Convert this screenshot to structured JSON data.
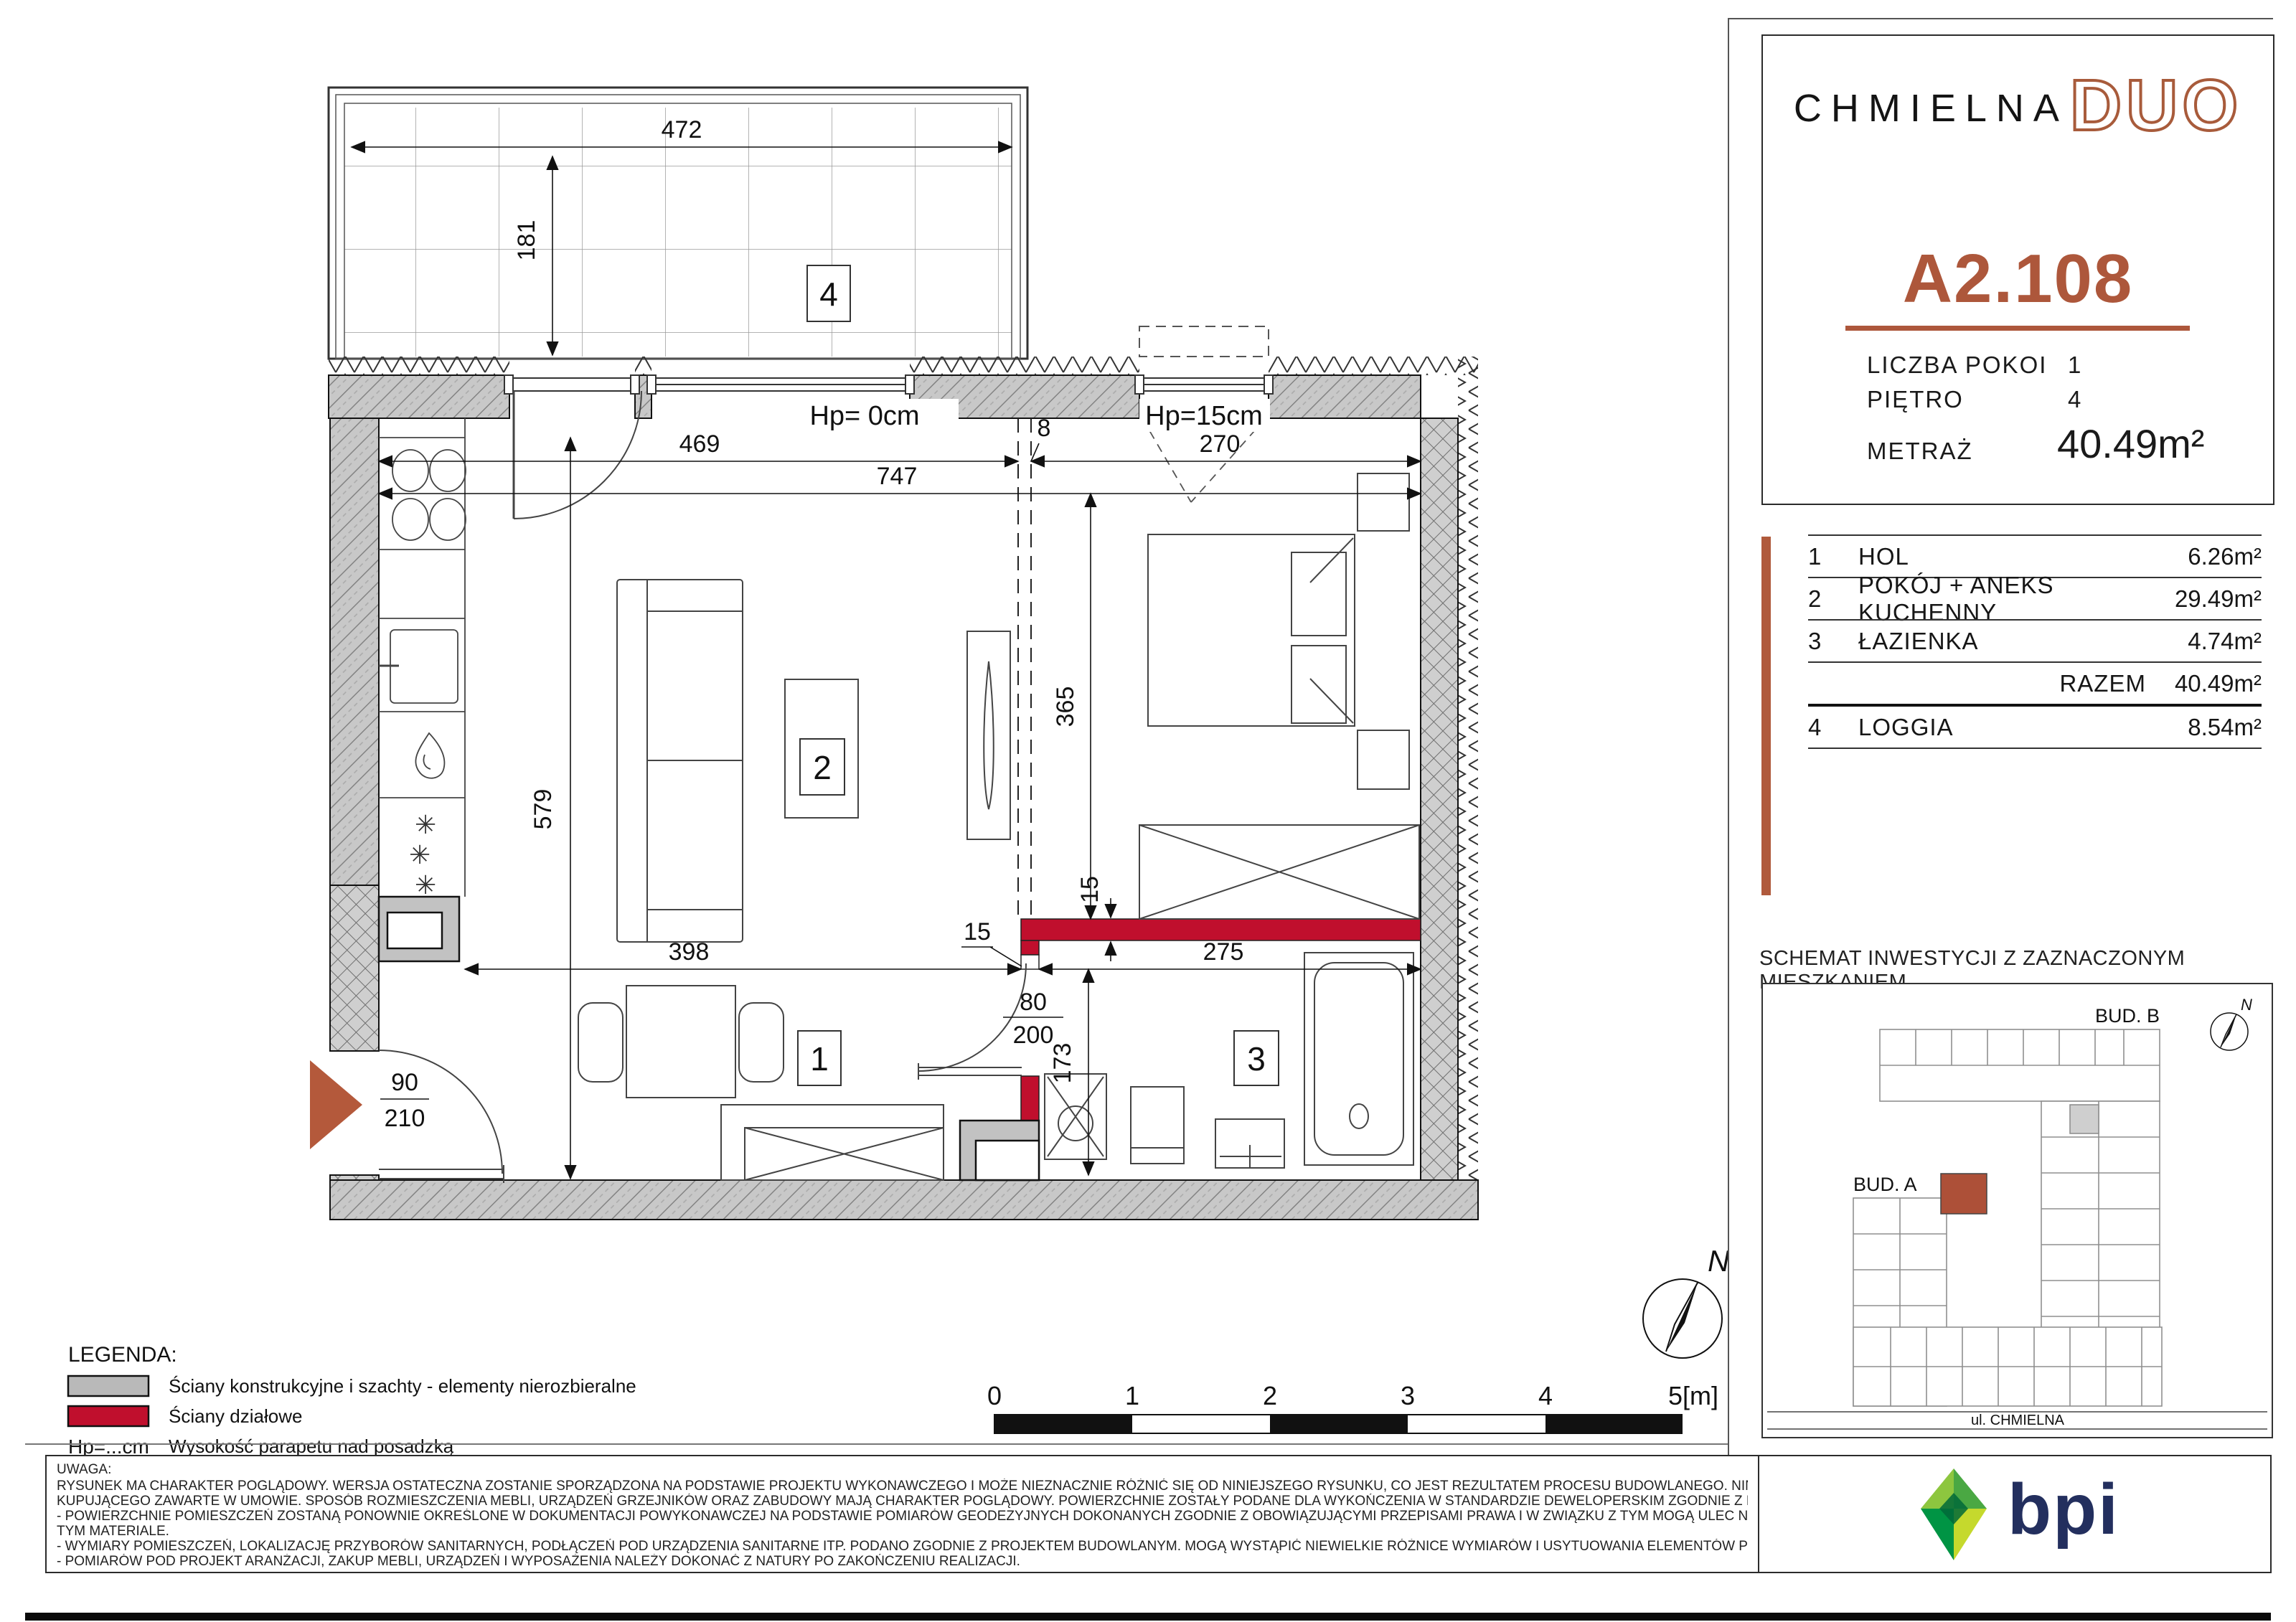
{
  "header": {
    "brand_name": "CHMIELNA",
    "brand_suffix": "DUO",
    "unit_id": "A2.108",
    "details": [
      {
        "label": "LICZBA POKOI",
        "value": "1"
      },
      {
        "label": "PIĘTRO",
        "value": "4"
      },
      {
        "label": "METRAŻ",
        "value": "40.49m²"
      }
    ]
  },
  "room_table": {
    "rows": [
      {
        "no": "1",
        "name": "HOL",
        "area": "6.26m²"
      },
      {
        "no": "2",
        "name": "POKÓJ + ANEKS KUCHENNY",
        "area": "29.49m²"
      },
      {
        "no": "3",
        "name": "ŁAZIENKA",
        "area": "4.74m²"
      }
    ],
    "total_label": "RAZEM",
    "total_value": "40.49m²",
    "loggia_row": {
      "no": "4",
      "name": "LOGGIA",
      "area": "8.54m²"
    }
  },
  "site_plan": {
    "title": "SCHEMAT INWESTYCJI Z ZAZNACZONYM MIESZKANIEM",
    "building_a": "BUD. A",
    "building_b": "BUD. B",
    "street": "ul. CHMIELNA",
    "north": "N"
  },
  "legend": {
    "title": "LEGENDA:",
    "items": [
      {
        "symbol": "wall-structural",
        "label": "Ściany konstrukcyjne i szachty - elementy nierozbieralne"
      },
      {
        "symbol": "wall-partition",
        "label": "Ściany działowe"
      },
      {
        "symbol": "Hp=...cm",
        "label": "Wysokość parapetu nad posadzką"
      },
      {
        "symbol": "dashed-outline",
        "label": "Możliwość wydzielenia aneksu sypialnego przez Klienta"
      }
    ]
  },
  "plan": {
    "room_numbers": {
      "loggia": "4",
      "living": "2",
      "hall": "1",
      "bath": "3"
    },
    "dims": {
      "d472": "472",
      "d181": "181",
      "d469": "469",
      "d747": "747",
      "d8": "8",
      "d270": "270",
      "d365": "365",
      "d579": "579",
      "d398": "398",
      "d275": "275",
      "d15_wall": "15",
      "d15_step": "15",
      "d173": "173",
      "bath_door": "80",
      "bath_door_h": "200",
      "entry_door": "90",
      "entry_door_h": "210",
      "hp0": "Hp= 0cm",
      "hp15": "Hp=15cm"
    },
    "scale_labels": [
      "0",
      "1",
      "2",
      "3",
      "4",
      "5[m]"
    ],
    "north": "N"
  },
  "notes": {
    "title": "UWAGA:",
    "lines": [
      "RYSUNEK MA CHARAKTER POGLĄDOWY. WERSJA OSTATECZNA ZOSTANIE SPORZĄDZONA NA PODSTAWIE PROJEKTU WYKONAWCZEGO I MOŻE NIEZNACZNIE RÓŻNIĆ SIĘ OD NINIEJSZEGO RYSUNKU, CO JEST REZULTATEM PROCESU BUDOWLANEGO. NINIEJSZE OSTRZEŻENIE NIE MA WPŁYWU NA UPRAWNIENIA",
      "KUPUJĄCEGO ZAWARTE W UMOWIE. SPOSÓB ROZMIESZCZENIA MEBLI, URZĄDZEŃ GRZEJNIKÓW ORAZ ZABUDOWY MAJĄ CHARAKTER POGLĄDOWY. POWIERZCHNIE ZOSTAŁY PODANE DLA WYKOŃCZENIA W STANDARDZIE DEWELOPERSKIM ZGODNIE Z NORMĄ PN-ISO 9836:2015-12.",
      "- POWIERZCHNIE POMIESZCZEŃ ZOSTANĄ PONOWNIE OKREŚLONE W DOKUMENTACJI POWYKONAWCZEJ NA PODSTAWIE POMIARÓW GEODEZYJNYCH DOKONANYCH ZGODNIE Z OBOWIĄZUJĄCYMI PRZEPISAMI PRAWA I W ZWIĄZKU Z TYM MOGĄ ULEC NIEZNACZNEJ ZMIANIE W STOSUNKU DO PODANYCH W",
      "TYM MATERIALE.",
      "- WYMIARY POMIESZCZEŃ, LOKALIZACJĘ PRZYBORÓW SANITARNYCH, PODŁĄCZEŃ POD URZĄDZENIA SANITARNE ITP. PODANO ZGODNIE Z PROJEKTEM BUDOWLANYM. MOGĄ WYSTĄPIĆ NIEWIELKIE RÓŻNICE WYMIARÓW I USYTUOWANIA ELEMENTÓW POWSTAŁE W TRAKCIE REALIZCJI PRAC BUDOWLANYCH.",
      "- POMIARÓW POD PROJEKT ARANŻACJI, ZAKUP MEBLI, URZĄDZEŃ I WYPOSAŻENIA NALEŻY DOKONAĆ Z NATURY PO ZAKOŃCZENIU REALIZACJI."
    ]
  },
  "footer_logo": {
    "text": "bpi"
  },
  "colors": {
    "accent_copper": "#AD573B",
    "wall_red": "#C00F2D",
    "wall_gray": "#C8C8C8",
    "logo_navy": "#232F5E"
  }
}
